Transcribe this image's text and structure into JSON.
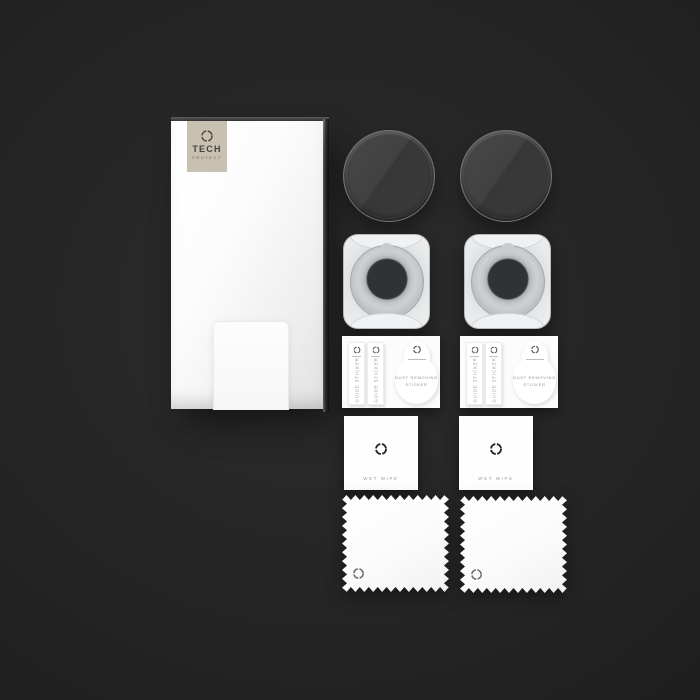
{
  "scene_items": [
    {
      "name": "retail-packaging-box",
      "qty": 1
    },
    {
      "name": "tempered-glass-lens-protector",
      "qty": 2
    },
    {
      "name": "installation-alignment-frame",
      "qty": 2
    },
    {
      "name": "guide-and-dust-sticker-sheet",
      "qty": 2
    },
    {
      "name": "wet-wipe-sachet",
      "qty": 2
    },
    {
      "name": "microfiber-cloth",
      "qty": 2
    }
  ],
  "brand": {
    "line1": "TECH",
    "line2": "PROTECT"
  },
  "labels": {
    "guide_sticker": "GUIDE STICKER",
    "dust_line1": "DUST REMOVING",
    "dust_line2": "STICKER",
    "wet_wipe": "WET WIPE"
  },
  "colors": {
    "background": "#1e1e1e",
    "logo_plate": "#c8c1b2",
    "brand_text": "#47423a",
    "muted_text": "#9a9a9a",
    "glass_tint": "#3d3d3d",
    "frame_body": "#e6e8ea"
  }
}
